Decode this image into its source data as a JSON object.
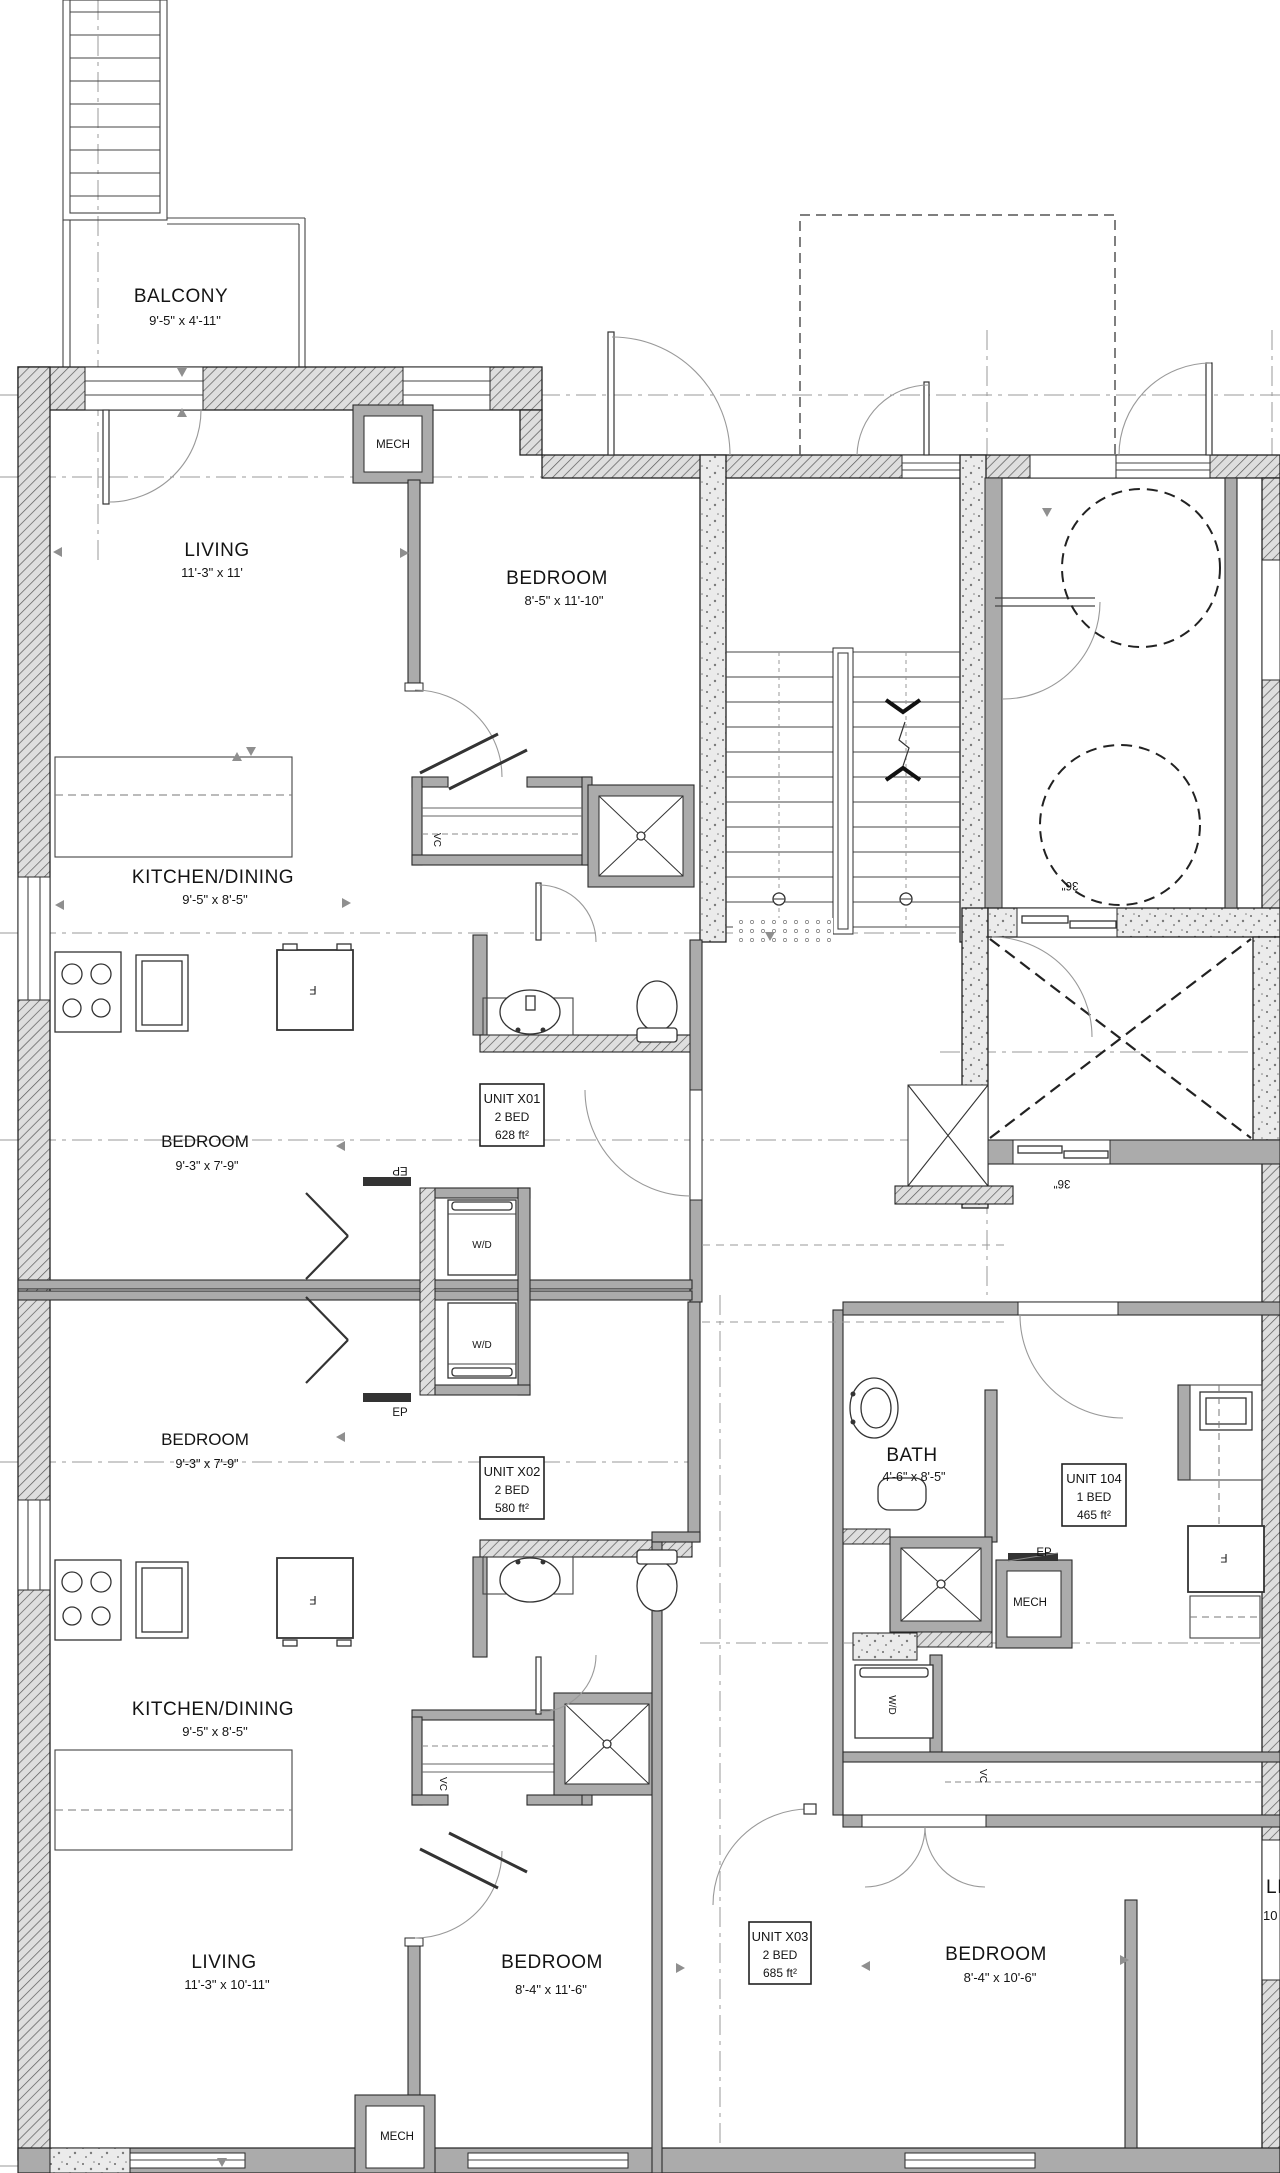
{
  "drawing": {
    "type": "residential floor plan",
    "labels": {
      "balcony": {
        "name": "BALCONY",
        "dims": "9'-5\" x 4'-11\""
      },
      "living_x01": {
        "name": "LIVING",
        "dims": "11'-3\" x 11'"
      },
      "bedroom_x01_main": {
        "name": "BEDROOM",
        "dims": "8'-5\" x 11'-10\""
      },
      "kitchen_x01": {
        "name": "KITCHEN/DINING",
        "dims": "9'-5\" x 8'-5\""
      },
      "bedroom_x01_2nd": {
        "name": "BEDROOM",
        "dims": "9'-3\" x 7'-9\""
      },
      "bedroom_x02_2nd": {
        "name": "BEDROOM",
        "dims": "9'-3\" x 7'-9\""
      },
      "kitchen_x02": {
        "name": "KITCHEN/DINING",
        "dims": "9'-5\" x 8'-5\""
      },
      "living_x02": {
        "name": "LIVING",
        "dims": "11'-3\" x 10'-11\""
      },
      "bedroom_x02_main": {
        "name": "BEDROOM",
        "dims": "8'-4\" x 11'-6\""
      },
      "bedroom_x03": {
        "name": "BEDROOM",
        "dims": "8'-4\" x 10'-6\""
      },
      "bath_104": {
        "name": "BATH",
        "dims": "4'-6\" x 8'-5\""
      },
      "living_edge": {
        "name": "LI",
        "dims": "10"
      }
    },
    "units": {
      "x01": {
        "id": "UNIT X01",
        "beds": "2 BED",
        "area": "628 ft²"
      },
      "x02": {
        "id": "UNIT X02",
        "beds": "2 BED",
        "area": "580 ft²"
      },
      "x03": {
        "id": "UNIT X03",
        "beds": "2 BED",
        "area": "685 ft²"
      },
      "u104": {
        "id": "UNIT 104",
        "beds": "1 BED",
        "area": "465 ft²"
      }
    },
    "tags": {
      "mech": "MECH",
      "wd": "W/D",
      "vc": "VC",
      "ep": "EP",
      "fridge": "F",
      "clearance": "36\""
    },
    "colors": {
      "wall_gray": "#ababab",
      "line_dark": "#2b2b2b",
      "grid_gray": "#9a9a9a",
      "paper": "#ffffff"
    }
  }
}
